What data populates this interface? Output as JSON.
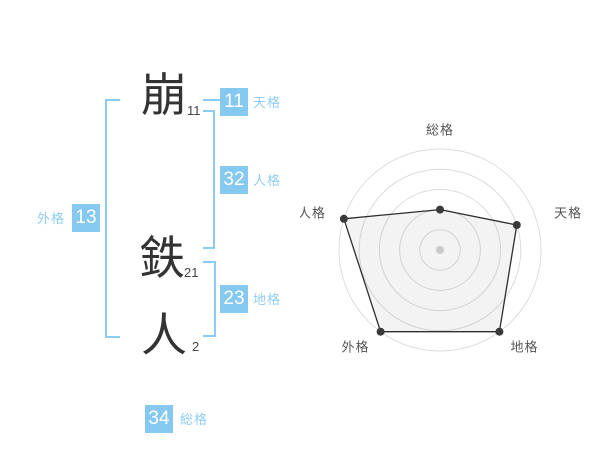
{
  "name_analysis": {
    "characters": [
      {
        "char": "崩",
        "strokes": "11"
      },
      {
        "char": "鉄",
        "strokes": "21"
      },
      {
        "char": "人",
        "strokes": "2"
      }
    ],
    "categories": {
      "tenkaku": {
        "label": "天格",
        "value": "11"
      },
      "jinkaku": {
        "label": "人格",
        "value": "32"
      },
      "chikaku": {
        "label": "地格",
        "value": "23"
      },
      "gaikaku": {
        "label": "外格",
        "value": "13"
      },
      "soukaku": {
        "label": "総格",
        "value": "34"
      }
    },
    "colors": {
      "accent_blue": "#85C9F0",
      "label_blue": "#8FCDF3",
      "ink": "#333333"
    }
  },
  "chart_data": {
    "type": "radar",
    "axes": [
      "総格",
      "天格",
      "地格",
      "外格",
      "人格"
    ],
    "values": [
      2,
      4,
      5,
      5,
      5
    ],
    "max": 5,
    "rings": 5,
    "grid": "concentric-circles",
    "colors": {
      "ring": "#dcdcdc",
      "polygon_stroke": "#2e2e2e",
      "polygon_fill": "rgba(80,80,80,0.07)",
      "vertex_dot": "#3a3a3a",
      "center_dot": "#c9c9c9",
      "axis_label": "#555555"
    }
  }
}
